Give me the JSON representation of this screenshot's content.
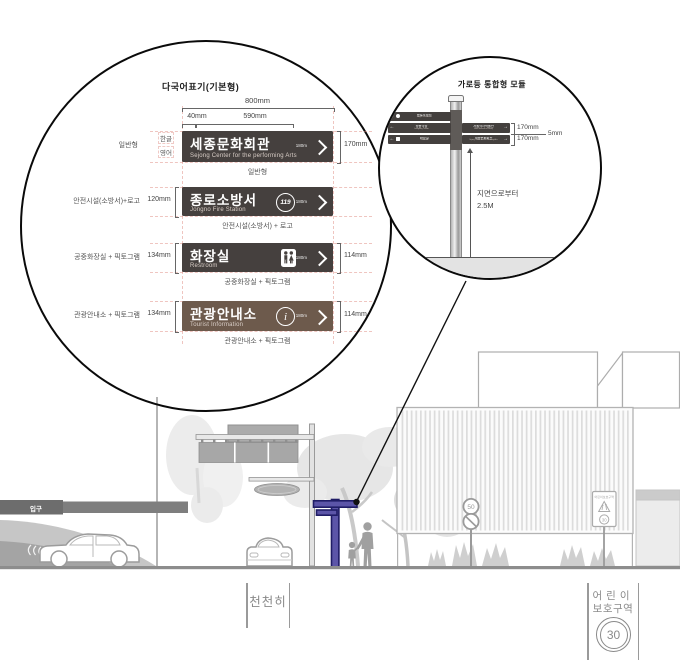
{
  "spec": {
    "title": "다국어표기(기본형)",
    "dim_total": "800mm",
    "dim_left": "40mm",
    "dim_mid": "590mm",
    "row1": {
      "type_label": "일반형",
      "lang1": "한글",
      "lang2": "영어",
      "kr": "세종문화회관",
      "en": "Sejong Center for the performing Arts",
      "dist": "180m",
      "dim_h": "170mm",
      "caption": "일반형"
    },
    "row2": {
      "label": "안전시설(소방서)+로고",
      "dim": "120mm",
      "kr": "종로소방서",
      "en": "Jongno Fire Station",
      "badge": "119",
      "dist": "180m",
      "caption": "안전시설(소방서) + 로고"
    },
    "row3": {
      "label": "공중화장실 + 픽토그램",
      "dim": "134mm",
      "kr": "화장실",
      "en": "Restroom",
      "dist": "180m",
      "dim_h": "114mm",
      "caption": "공중화장실 + 픽토그램"
    },
    "row4": {
      "label": "관광안내소 + 픽토그램",
      "dim": "134mm",
      "kr": "관광안내소",
      "en": "Tourist Information",
      "dist": "180m",
      "dim_h": "114mm",
      "caption": "관광안내소 + 픽토그램"
    }
  },
  "module": {
    "title": "가로등 통합형 모듈",
    "dim1": "170mm",
    "dim2": "170mm",
    "gap": "5mm",
    "note1": "지면으로부터",
    "note2": "2.5M",
    "left_rows": [
      {
        "arrow": "←",
        "kr": "종로소방서",
        "en": "Jongno Fire Station"
      },
      {
        "arrow": "←",
        "kr": "정동극장",
        "en": "Jeongdong Theater"
      },
      {
        "arrow": "←",
        "kr": "화장실",
        "en": "Restroom"
      }
    ],
    "right_rows": [
      {
        "kr": "서울역사박물관",
        "en": "Seoul Museum of History",
        "arrow": "→"
      },
      {
        "kr": "세종문화회관",
        "en": "Sejong Center for the Performing Arts",
        "arrow": "→"
      }
    ]
  },
  "scene": {
    "entrance": "입구",
    "speed_limit": "50",
    "school_sign_title": "어린이보호구역",
    "school_sign_speed": "30"
  },
  "road": {
    "slow": "천천히",
    "kids1": "어린이",
    "kids2": "보호구역",
    "speed": "30"
  },
  "colors": {
    "sign_dark": "#45403e",
    "sign_brown": "#6d5a4c",
    "pole_purple": "#5c55a8",
    "pole_outline": "#201d66"
  }
}
